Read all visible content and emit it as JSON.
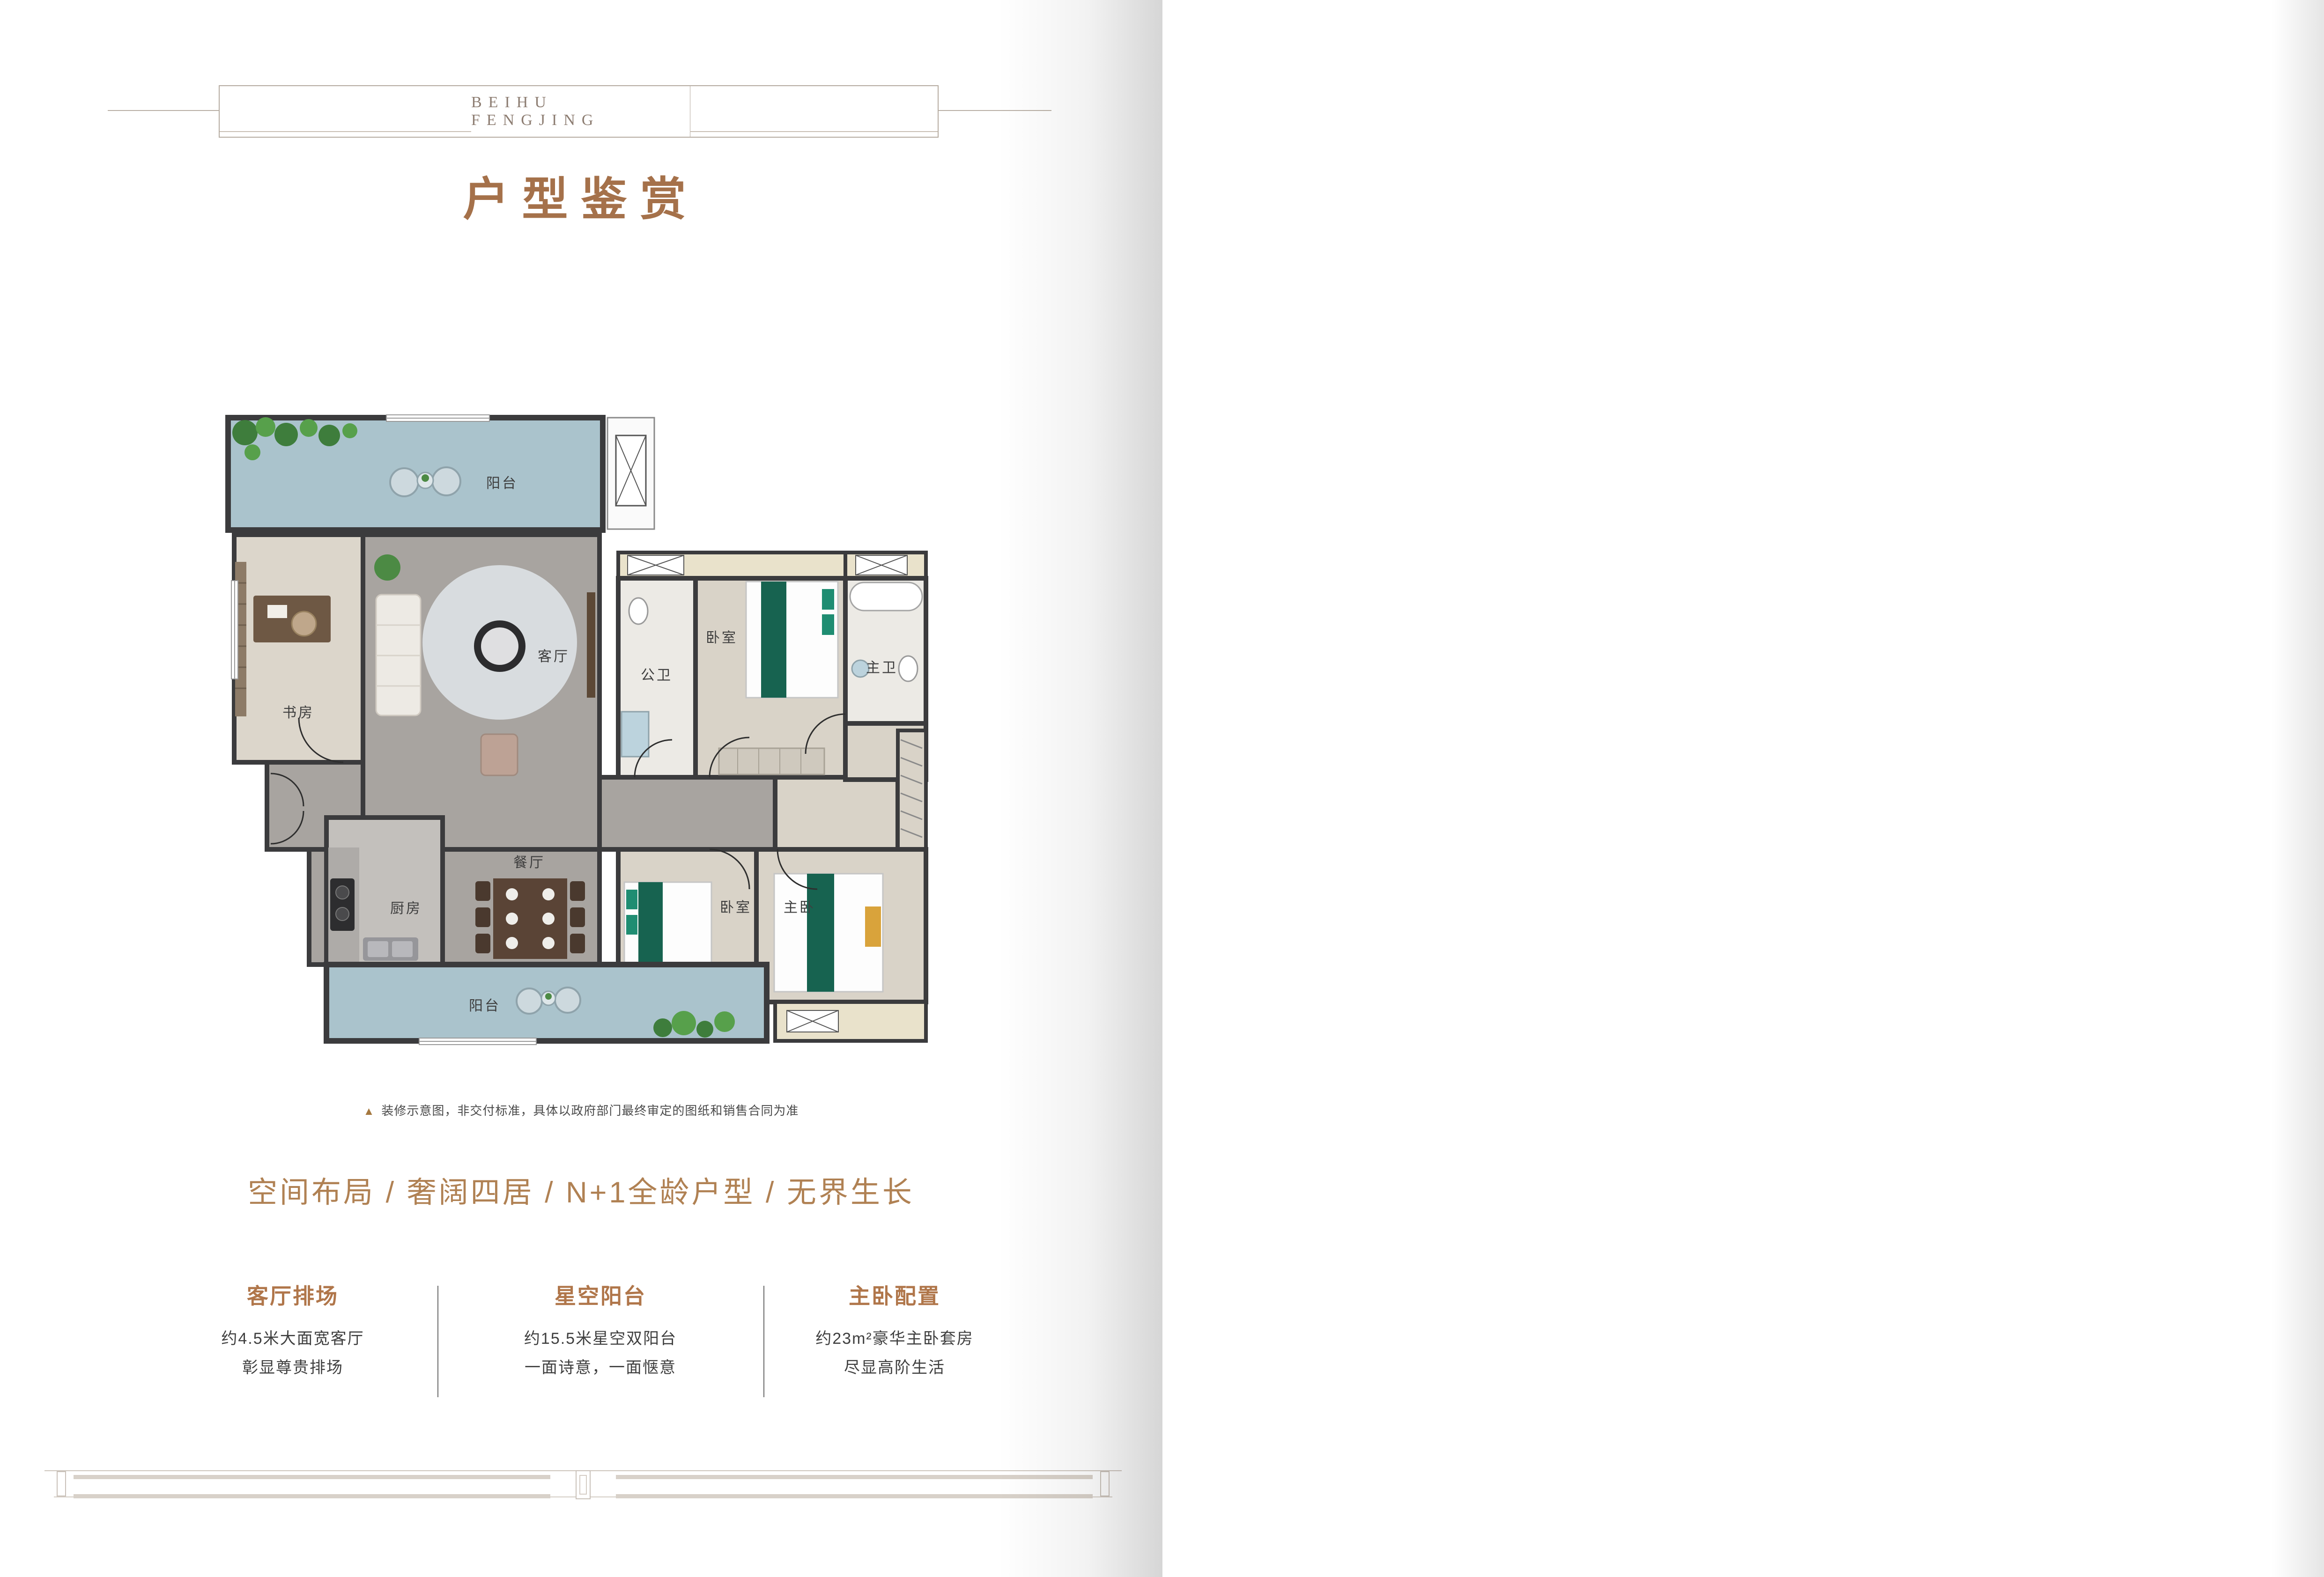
{
  "brand": {
    "wordmark": "BEIHU FENGJING"
  },
  "rooms": {
    "balcony": "阳台",
    "study": "书房",
    "living": "客厅",
    "public_bath": "公卫",
    "bedroom": "卧室",
    "master_bath": "主卫",
    "dining": "餐厅",
    "kitchen": "厨房",
    "master_bedroom": "主卧"
  },
  "left_page": {
    "title": "户型鉴赏",
    "disclaimer": "装修示意图，非交付标准，具体以政府部门最终审定的图纸和销售合同为准",
    "tagline": "空间布局 / 奢阔四居 / N+1全龄户型 / 无界生长",
    "features": [
      {
        "title": "客厅排场",
        "line1": "约4.5米大面宽客厅",
        "line2": "彰显尊贵排场"
      },
      {
        "title": "星空阳台",
        "line1": "约15.5米星空双阳台",
        "line2": "一面诗意，一面惬意"
      },
      {
        "title": "主卧配置",
        "line1": "约23m²豪华主卧套房",
        "line2": "尽显高阶生活"
      }
    ]
  },
  "right_page": {
    "badge": {
      "label_line1": "建筑",
      "label_line2": "面积",
      "approx": "约",
      "area_value": "142.26m",
      "area_sup": "2",
      "layout": "3+1房2厅2卫"
    },
    "legend": [
      {
        "label": "计算一半面积",
        "color": "#b5ddef"
      },
      {
        "label": "不计算面积",
        "color": "#faf0cd"
      }
    ],
    "notes": {
      "heading": "特殊说明:",
      "body": "本广告作为要约邀请，该户型仅作为标准户型房屋示意，所有图例以及文字、相关数据、功能以及规划仅作为示意，仅供参考;相同户型单位因楼栋、楼层、单元等差别，局部结构、面积可能不同，房屋最终以《商品房买卖合同》及补充协议为准;如合同未予规定的，则以房屋最终实际状况或政府最后审批为准。对项目周边环境、交通、教育、商业以及其他相关配套的介绍，仅提供相关信息，不意味着本公司对此作出承诺，买卖双方的权利义务以最终签订的买卖合同为准。"
    }
  },
  "colors": {
    "accent_brown": "#a97c55",
    "title_brown": "#a5714a",
    "plan_line_brown": "#b9906a",
    "plan_wall_brown": "#b5895c",
    "legend_half_blue": "#b5ddef",
    "legend_none_yellow": "#faf0cd",
    "render_wall_dark": "#3b3b3d",
    "render_balcony_blue": "#aac3cc",
    "render_floor_gray": "#a8a4a0",
    "render_floor_wood": "#d9d3c8"
  }
}
